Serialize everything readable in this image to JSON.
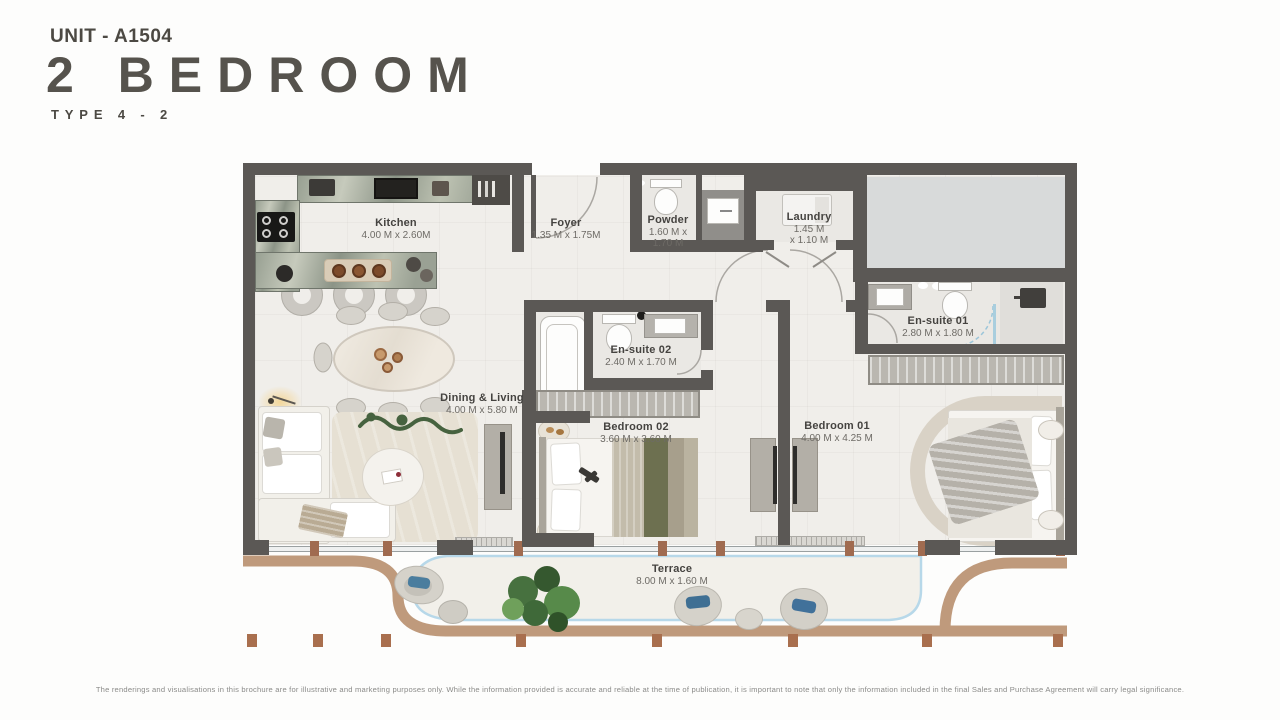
{
  "header": {
    "unit_code": "UNIT - A1504",
    "title": "2 BEDROOM",
    "type_label": "TYPE 4 - 2"
  },
  "rooms": {
    "kitchen": {
      "name": "Kitchen",
      "dims": "4.00 M x 2.60M"
    },
    "foyer": {
      "name": "Foyer",
      "dims": "1.35 M x 1.75M"
    },
    "powder": {
      "name": "Powder",
      "dims_line1": "1.60 M x",
      "dims_line2": "1.70 M"
    },
    "laundry": {
      "name": "Laundry",
      "dims_line1": "1.45 M",
      "dims_line2": "x 1.10 M"
    },
    "ensuite01": {
      "name": "En-suite 01",
      "dims": "2.80 M x 1.80 M"
    },
    "ensuite02": {
      "name": "En-suite 02",
      "dims": "2.40 M x 1.70 M"
    },
    "dining_living": {
      "name": "Dining & Living",
      "dims": "4.00 M x 5.80 M"
    },
    "bedroom02": {
      "name": "Bedroom 02",
      "dims": "3.60 M x 3.60 M"
    },
    "bedroom01": {
      "name": "Bedroom 01",
      "dims": "4.00 M x 4.25 M"
    },
    "terrace": {
      "name": "Terrace",
      "dims": "8.00 M x 1.60 M"
    }
  },
  "disclaimer": "The renderings and visualisations in this brochure are for illustrative and marketing purposes only. While the information provided is accurate and reliable at the time of publication, it is important to note that only the information included in the final Sales and Purchase Agreement will carry legal significance.",
  "colors": {
    "wall": "#5b5855",
    "floor": "#f0eeea",
    "terrace_edge": "#b7d8e9",
    "curb_brown": "#bf9a7c",
    "mullion_brown": "#a06b50",
    "marble_green": "#98a092",
    "olive_accent": "#6d7050",
    "cushion_blue": "#4a7d9e"
  }
}
